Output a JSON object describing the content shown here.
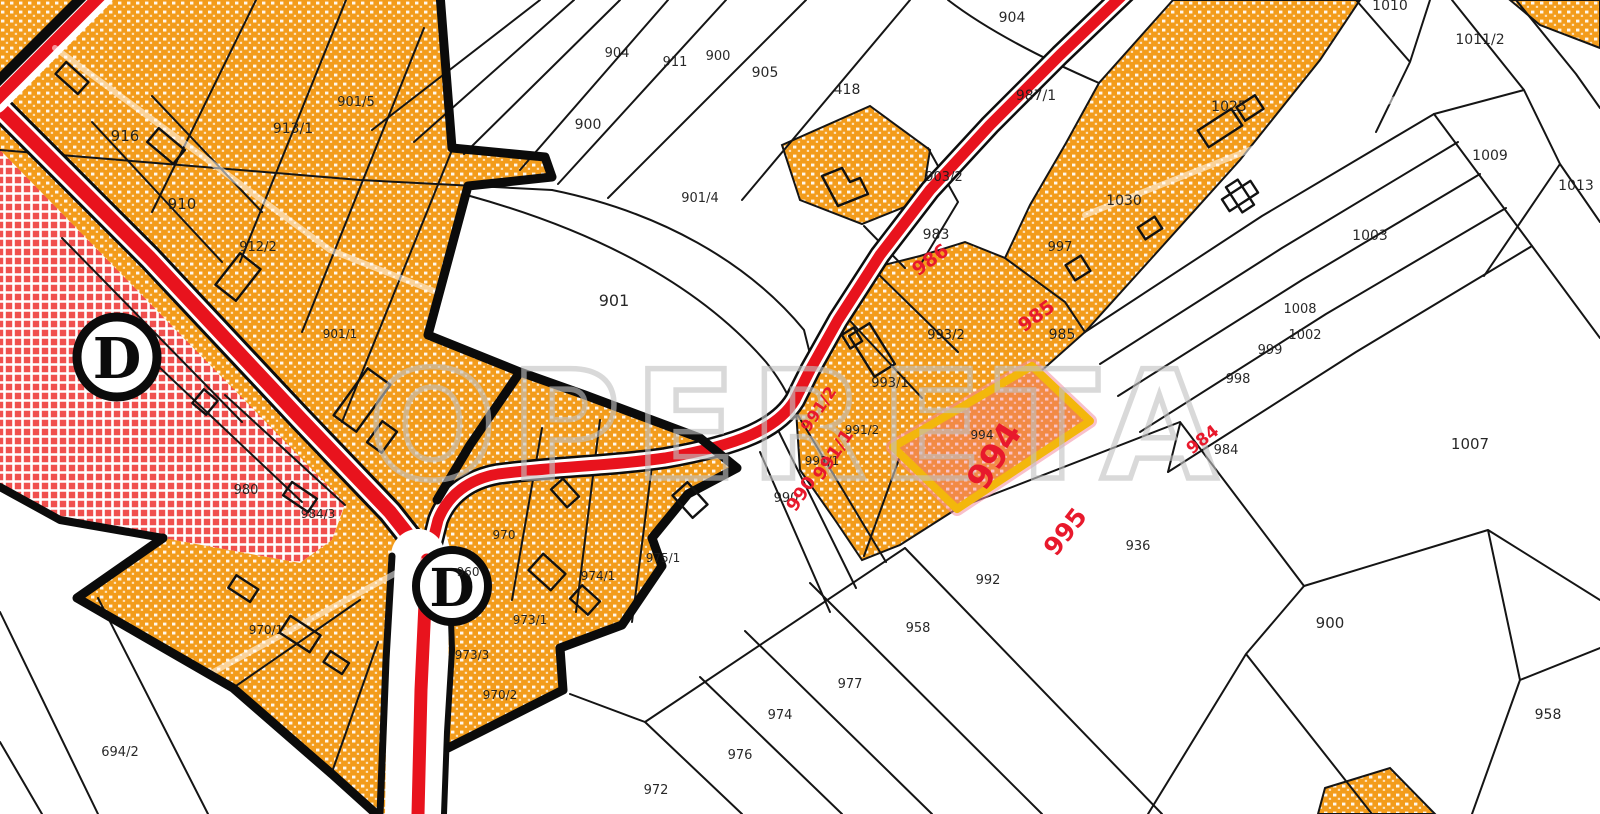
{
  "map": {
    "watermark": "OPERETA",
    "highlighted_parcel": {
      "number": "994"
    },
    "zone_markers": [
      {
        "label": "D"
      },
      {
        "label": "D"
      }
    ],
    "colors": {
      "zone_orange": "#F39C1B",
      "zone_red_crosshatch": "#F0504E",
      "road_red": "#E8131D",
      "highlight_yellow": "#F3B70C",
      "highlight_tint": "rgba(242,110,140,0.38)",
      "label_black": "#1c1c1c",
      "label_red": "#E8192C",
      "watermark_gray": "#C2C2C2"
    },
    "black_labels": [
      {
        "t": "916",
        "x": 125,
        "y": 141,
        "s": 15
      },
      {
        "t": "910",
        "x": 182,
        "y": 209,
        "s": 15
      },
      {
        "t": "913/1",
        "x": 293,
        "y": 133,
        "s": 14
      },
      {
        "t": "901/5",
        "x": 356,
        "y": 106,
        "s": 13
      },
      {
        "t": "912/2",
        "x": 258,
        "y": 251,
        "s": 13
      },
      {
        "t": "904",
        "x": 617,
        "y": 57,
        "s": 13
      },
      {
        "t": "911",
        "x": 675,
        "y": 66,
        "s": 13
      },
      {
        "t": "900",
        "x": 718,
        "y": 60,
        "s": 13
      },
      {
        "t": "905",
        "x": 765,
        "y": 77,
        "s": 14
      },
      {
        "t": "900",
        "x": 588,
        "y": 129,
        "s": 14
      },
      {
        "t": "901",
        "x": 614,
        "y": 306,
        "s": 16
      },
      {
        "t": "901/4",
        "x": 700,
        "y": 202,
        "s": 13
      },
      {
        "t": "418",
        "x": 847,
        "y": 94,
        "s": 14
      },
      {
        "t": "904",
        "x": 1012,
        "y": 22,
        "s": 14
      },
      {
        "t": "987/1",
        "x": 1036,
        "y": 100,
        "s": 14
      },
      {
        "t": "903/2",
        "x": 944,
        "y": 181,
        "s": 13
      },
      {
        "t": "983",
        "x": 936,
        "y": 239,
        "s": 14
      },
      {
        "t": "997",
        "x": 1060,
        "y": 251,
        "s": 13
      },
      {
        "t": "985",
        "x": 1062,
        "y": 339,
        "s": 14
      },
      {
        "t": "1025",
        "x": 1229,
        "y": 111,
        "s": 14
      },
      {
        "t": "1030",
        "x": 1124,
        "y": 205,
        "s": 14
      },
      {
        "t": "1010",
        "x": 1390,
        "y": 10,
        "s": 14
      },
      {
        "t": "1011/2",
        "x": 1480,
        "y": 44,
        "s": 14
      },
      {
        "t": "1009",
        "x": 1490,
        "y": 160,
        "s": 14
      },
      {
        "t": "1013",
        "x": 1576,
        "y": 190,
        "s": 14
      },
      {
        "t": "1003",
        "x": 1370,
        "y": 240,
        "s": 14
      },
      {
        "t": "1008",
        "x": 1300,
        "y": 313,
        "s": 13
      },
      {
        "t": "1002",
        "x": 1305,
        "y": 339,
        "s": 13
      },
      {
        "t": "999",
        "x": 1270,
        "y": 354,
        "s": 13
      },
      {
        "t": "998",
        "x": 1238,
        "y": 383,
        "s": 13
      },
      {
        "t": "984",
        "x": 1226,
        "y": 454,
        "s": 13
      },
      {
        "t": "1007",
        "x": 1470,
        "y": 449,
        "s": 15
      },
      {
        "t": "993/2",
        "x": 946,
        "y": 339,
        "s": 13
      },
      {
        "t": "993/1",
        "x": 890,
        "y": 387,
        "s": 13
      },
      {
        "t": "991/2",
        "x": 862,
        "y": 434,
        "s": 12
      },
      {
        "t": "991/1",
        "x": 822,
        "y": 465,
        "s": 12
      },
      {
        "t": "990",
        "x": 786,
        "y": 502,
        "s": 13
      },
      {
        "t": "994",
        "x": 982,
        "y": 439,
        "s": 12
      },
      {
        "t": "992",
        "x": 988,
        "y": 584,
        "s": 13
      },
      {
        "t": "936",
        "x": 1138,
        "y": 550,
        "s": 13
      },
      {
        "t": "900",
        "x": 1330,
        "y": 628,
        "s": 15
      },
      {
        "t": "958",
        "x": 1548,
        "y": 719,
        "s": 14
      },
      {
        "t": "958",
        "x": 918,
        "y": 632,
        "s": 13
      },
      {
        "t": "977",
        "x": 850,
        "y": 688,
        "s": 13
      },
      {
        "t": "974",
        "x": 780,
        "y": 719,
        "s": 13
      },
      {
        "t": "976",
        "x": 740,
        "y": 759,
        "s": 13
      },
      {
        "t": "972",
        "x": 656,
        "y": 794,
        "s": 13
      },
      {
        "t": "975/1",
        "x": 663,
        "y": 562,
        "s": 12
      },
      {
        "t": "974/1",
        "x": 598,
        "y": 580,
        "s": 12
      },
      {
        "t": "970",
        "x": 504,
        "y": 539,
        "s": 12
      },
      {
        "t": "973/1",
        "x": 530,
        "y": 624,
        "s": 12
      },
      {
        "t": "973/3",
        "x": 472,
        "y": 659,
        "s": 12
      },
      {
        "t": "970/2",
        "x": 500,
        "y": 699,
        "s": 12
      },
      {
        "t": "980",
        "x": 246,
        "y": 494,
        "s": 13
      },
      {
        "t": "984/3",
        "x": 318,
        "y": 518,
        "s": 12
      },
      {
        "t": "901/1",
        "x": 340,
        "y": 338,
        "s": 12
      },
      {
        "t": "970/1",
        "x": 266,
        "y": 634,
        "s": 12
      },
      {
        "t": "960",
        "x": 468,
        "y": 576,
        "s": 12
      },
      {
        "t": "694/2",
        "x": 120,
        "y": 756,
        "s": 13
      }
    ],
    "red_labels": [
      {
        "t": "986",
        "x": 934,
        "y": 265,
        "s": 19,
        "r": -36
      },
      {
        "t": "985",
        "x": 1040,
        "y": 321,
        "s": 19,
        "r": -36
      },
      {
        "t": "991/2",
        "x": 823,
        "y": 412,
        "s": 16,
        "r": -56
      },
      {
        "t": "991/1",
        "x": 838,
        "y": 458,
        "s": 18,
        "r": -56
      },
      {
        "t": "990",
        "x": 806,
        "y": 497,
        "s": 18,
        "r": -56
      },
      {
        "t": "994",
        "x": 1004,
        "y": 462,
        "s": 34,
        "r": -58
      },
      {
        "t": "984",
        "x": 1206,
        "y": 444,
        "s": 17,
        "r": -38
      },
      {
        "t": "995",
        "x": 1072,
        "y": 537,
        "s": 25,
        "r": -52
      }
    ]
  }
}
